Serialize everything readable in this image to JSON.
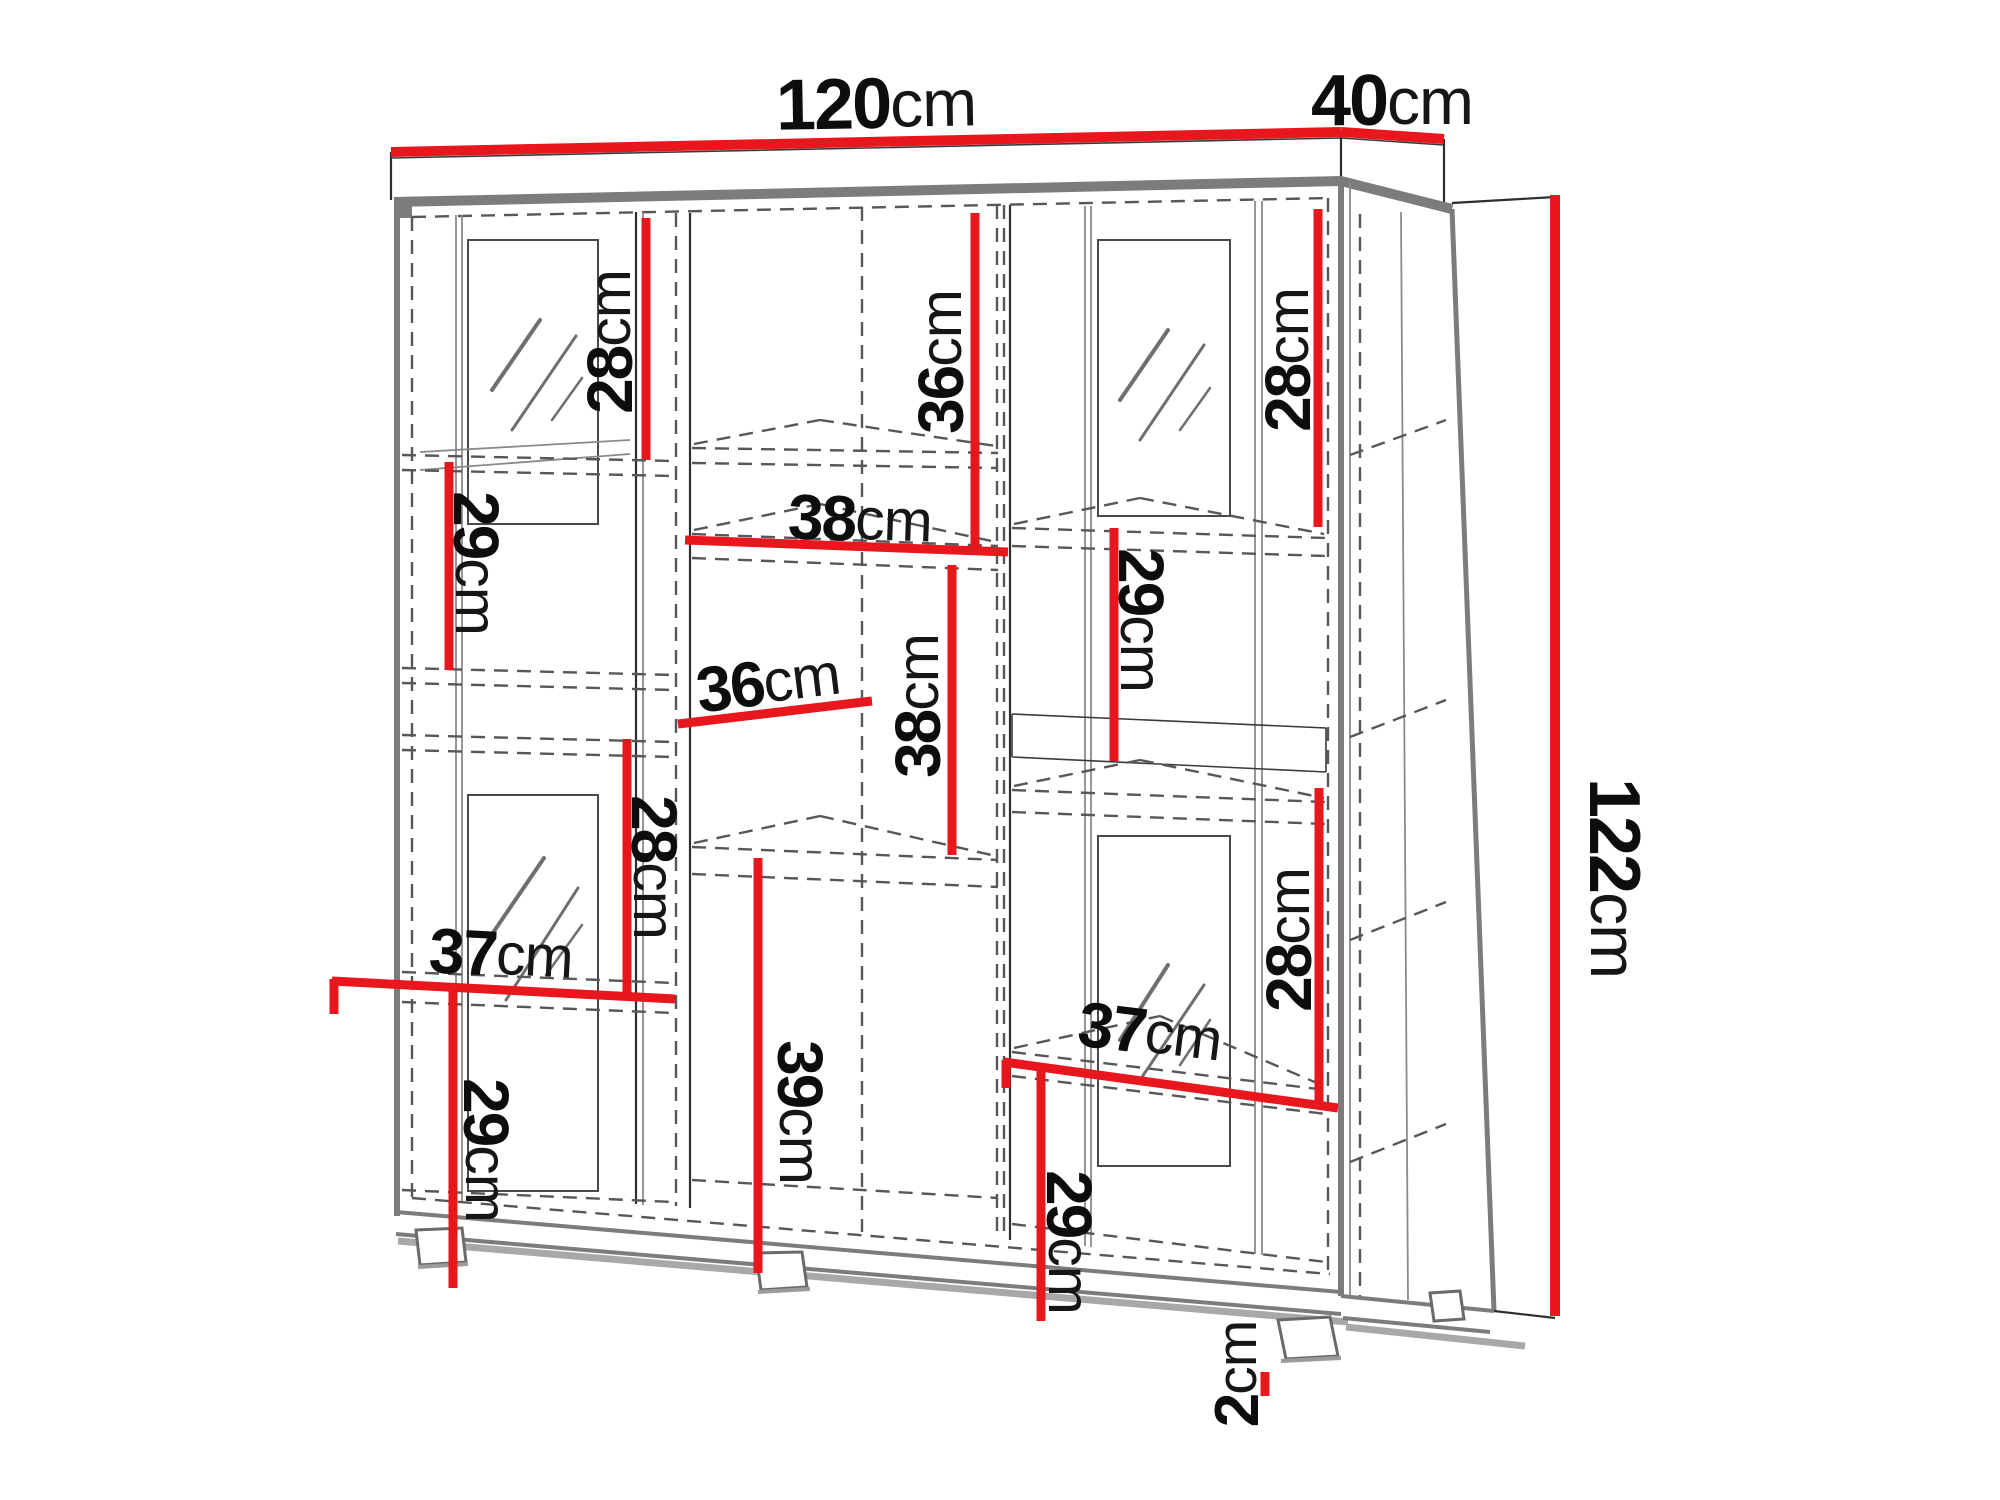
{
  "unit": "cm",
  "colors": {
    "background": "#ffffff",
    "dimension": "#e8161d",
    "text": "#0d0d0d",
    "carcass": "#7c7c7c",
    "thin_line": "#3a3a3a",
    "dashed_line": "#575757"
  },
  "overall_dimensions": {
    "width": "120cm",
    "depth": "40cm",
    "height": "122cm",
    "foot_height": "2cm"
  },
  "dimensions": [
    {
      "id": "width-top",
      "number": "120",
      "unit": "cm",
      "role": "overall-width",
      "line": [
        391,
        152,
        1341,
        132
      ],
      "label": [
        876,
        104
      ],
      "rotate": -1,
      "size": 72,
      "thick": 10
    },
    {
      "id": "depth-top",
      "number": "40",
      "unit": "cm",
      "role": "overall-depth",
      "line": [
        1341,
        132,
        1444,
        139
      ],
      "label": [
        1392,
        101
      ],
      "rotate": 0,
      "size": 72,
      "thick": 10
    },
    {
      "id": "height-right",
      "number": "122",
      "unit": "cm",
      "role": "overall-height",
      "line": [
        1555,
        195,
        1555,
        1316
      ],
      "label": [
        1614,
        878
      ],
      "rotate": 90,
      "size": 72,
      "thick": 10
    },
    {
      "id": "left-top-28",
      "number": "28",
      "unit": "cm",
      "role": "section-height",
      "line": [
        646,
        218,
        646,
        460
      ],
      "label": [
        610,
        342
      ],
      "rotate": -90,
      "size": 64,
      "thick": 9
    },
    {
      "id": "left-mid-29",
      "number": "29",
      "unit": "cm",
      "role": "section-height",
      "line": [
        449,
        462,
        449,
        670
      ],
      "label": [
        476,
        563
      ],
      "rotate": 90,
      "size": 64,
      "thick": 9
    },
    {
      "id": "left-low-28",
      "number": "28",
      "unit": "cm",
      "role": "section-height",
      "line": [
        627,
        739,
        627,
        996
      ],
      "label": [
        654,
        867
      ],
      "rotate": 90,
      "size": 64,
      "thick": 9
    },
    {
      "id": "left-37",
      "number": "37",
      "unit": "cm",
      "role": "section-width",
      "line": [
        332,
        981,
        675,
        999
      ],
      "label": [
        501,
        954
      ],
      "rotate": 3,
      "size": 64,
      "thick": 9,
      "ticks": [
        [
          334,
          979,
          334,
          1014
        ]
      ]
    },
    {
      "id": "left-bot-29",
      "number": "29",
      "unit": "cm",
      "role": "section-height",
      "line": [
        453,
        989,
        453,
        1288
      ],
      "label": [
        486,
        1150
      ],
      "rotate": 90,
      "size": 64,
      "thick": 9
    },
    {
      "id": "mid-top-36",
      "number": "36",
      "unit": "cm",
      "role": "section-height",
      "line": [
        975,
        213,
        975,
        549
      ],
      "label": [
        941,
        362
      ],
      "rotate": -90,
      "size": 64,
      "thick": 9
    },
    {
      "id": "mid-38-shelf",
      "number": "38",
      "unit": "cm",
      "role": "shelf-width",
      "line": [
        685,
        540,
        1008,
        552
      ],
      "label": [
        860,
        519
      ],
      "rotate": 2,
      "size": 64,
      "thick": 9
    },
    {
      "id": "mid-36-depth",
      "number": "36",
      "unit": "cm",
      "role": "shelf-depth",
      "line": [
        678,
        724,
        872,
        701
      ],
      "label": [
        768,
        682
      ],
      "rotate": -7,
      "size": 64,
      "thick": 9
    },
    {
      "id": "mid-38-v",
      "number": "38",
      "unit": "cm",
      "role": "section-height",
      "line": [
        952,
        565,
        952,
        855
      ],
      "label": [
        918,
        706
      ],
      "rotate": -90,
      "size": 64,
      "thick": 9
    },
    {
      "id": "mid-39",
      "number": "39",
      "unit": "cm",
      "role": "section-height",
      "line": [
        758,
        858,
        758,
        1273
      ],
      "label": [
        800,
        1112
      ],
      "rotate": 90,
      "size": 64,
      "thick": 9
    },
    {
      "id": "right-top-28",
      "number": "28",
      "unit": "cm",
      "role": "section-height",
      "line": [
        1318,
        209,
        1318,
        527
      ],
      "label": [
        1288,
        360
      ],
      "rotate": -90,
      "size": 64,
      "thick": 9
    },
    {
      "id": "right-29",
      "number": "29",
      "unit": "cm",
      "role": "section-height",
      "line": [
        1114,
        528,
        1114,
        761
      ],
      "label": [
        1141,
        620
      ],
      "rotate": 90,
      "size": 64,
      "thick": 9
    },
    {
      "id": "right-low-28",
      "number": "28",
      "unit": "cm",
      "role": "section-height",
      "line": [
        1319,
        788,
        1319,
        1105
      ],
      "label": [
        1289,
        940
      ],
      "rotate": -90,
      "size": 64,
      "thick": 9
    },
    {
      "id": "right-37",
      "number": "37",
      "unit": "cm",
      "role": "section-width",
      "line": [
        1004,
        1062,
        1338,
        1108
      ],
      "label": [
        1150,
        1032
      ],
      "rotate": 7,
      "size": 64,
      "thick": 9,
      "ticks": [
        [
          1006,
          1060,
          1006,
          1088
        ]
      ]
    },
    {
      "id": "right-bot-29",
      "number": "29",
      "unit": "cm",
      "role": "section-height",
      "line": [
        1041,
        1067,
        1041,
        1321
      ],
      "label": [
        1069,
        1242
      ],
      "rotate": 90,
      "size": 64,
      "thick": 9
    },
    {
      "id": "foot-2",
      "number": "2",
      "unit": "cm",
      "role": "foot-height",
      "line": [
        1265,
        1372,
        1265,
        1396
      ],
      "label": [
        1237,
        1374
      ],
      "rotate": -90,
      "size": 62,
      "thick": 9
    }
  ]
}
